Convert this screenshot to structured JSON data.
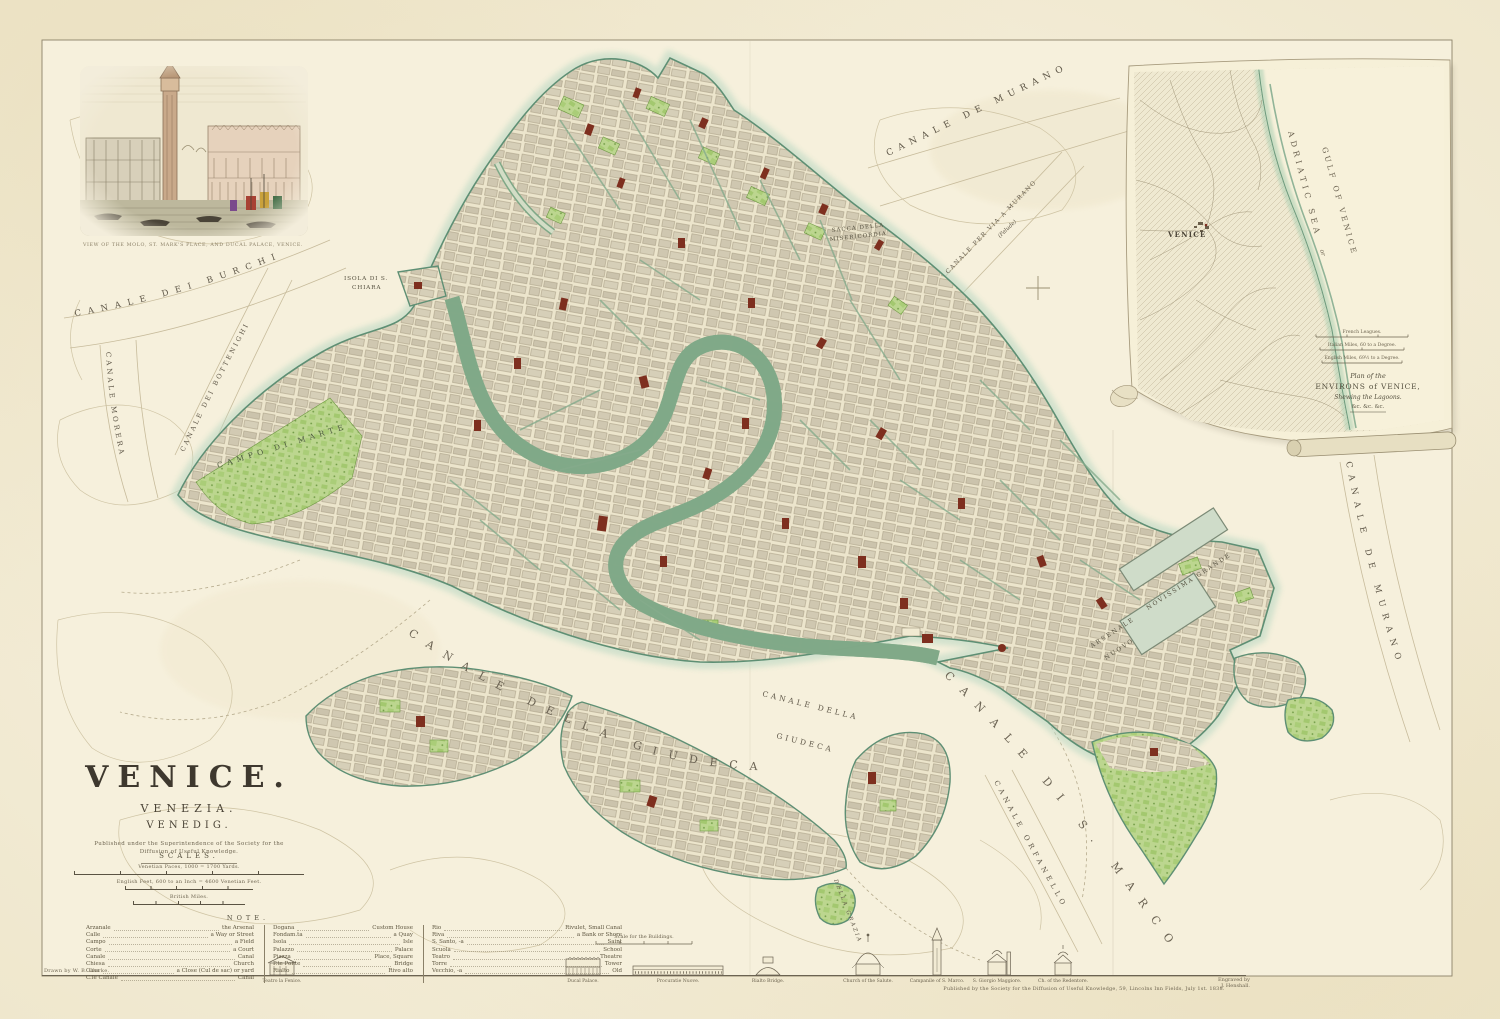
{
  "page": {
    "paper": "#f3eddb",
    "ink": "#5f5748",
    "coast": "#7ba68b",
    "water": "#f6f0dc",
    "land": "#d5cebb",
    "garden": "#b9d48b",
    "landmark": "#7e2f1f"
  },
  "title_block": {
    "title": "VENICE.",
    "subtitle1": "VENEZIA.",
    "subtitle2": "VENEDIG.",
    "imprint_line1": "Published under the Superintendence of the Society for the",
    "imprint_line2": "Diffusion of Useful Knowledge."
  },
  "scales_block": {
    "heading": "SCALES.",
    "bars": [
      {
        "label": "Venetian Paces, 1000 = 1700 Yards."
      },
      {
        "label": "English Feet, 600 to an Inch = 4600 Venetian Feet."
      },
      {
        "label": "British Miles."
      }
    ]
  },
  "note_block": {
    "heading": "NOTE.",
    "col1": [
      {
        "term": "Arzanale",
        "def": "the Arsenal"
      },
      {
        "term": "Calle",
        "def": "a Way or Street"
      },
      {
        "term": "Campo",
        "def": "a Field"
      },
      {
        "term": "Corte",
        "def": "a Court"
      },
      {
        "term": "Canale",
        "def": "Canal"
      },
      {
        "term": "Chiesa",
        "def": "Church"
      },
      {
        "term": "Casa",
        "def": "a Close (Cul de sac) or yard"
      },
      {
        "term": "C.le Canale",
        "def": "Canal"
      }
    ],
    "col2": [
      {
        "term": "Dogana",
        "def": "Custom House"
      },
      {
        "term": "Fondam.ta",
        "def": "a Quay"
      },
      {
        "term": "Isola",
        "def": "Isle"
      },
      {
        "term": "Palazzo",
        "def": "Palace"
      },
      {
        "term": "Piazza",
        "def": "Place, Square"
      },
      {
        "term": "P.te Ponte",
        "def": "Bridge"
      },
      {
        "term": "Rialto",
        "def": "Rivo alto"
      }
    ],
    "col3": [
      {
        "term": "Rio",
        "def": "Rivulet, Small Canal"
      },
      {
        "term": "Riva",
        "def": "a Bank or Shore"
      },
      {
        "term": "S. Santo, -a",
        "def": "Saint"
      },
      {
        "term": "Scuola",
        "def": "School"
      },
      {
        "term": "Teatro",
        "def": "Theatre"
      },
      {
        "term": "Torre",
        "def": "Tower"
      },
      {
        "term": "Vecchio, -a",
        "def": "Old"
      }
    ]
  },
  "vignette": {
    "caption": "VIEW OF THE MOLO, ST. MARK'S PLACE, AND DUCAL PALACE, VENICE."
  },
  "map_labels": {
    "burchi": "CANALE DEI BURCHI",
    "morera": "CANALE MORERA",
    "bottenighi": "CANALE DEI BOTTENIGHI",
    "murano_top": "CANALE DE MURANO",
    "per_via_murano": "CANALE PER VIA A MURANO",
    "palude": "(Palude)",
    "sacca_line1": "SACCA DELLA",
    "sacca_line2": "MISERICORDIA",
    "isola_chiara_line1": "ISOLA DI S.",
    "isola_chiara_line2": "CHIARA",
    "campo_di_marte": "CAMPO DI MARTE",
    "giudeca_curve": "CANALE DELLA GIUDECA",
    "giudeca2_line1": "CANALE DELLA",
    "giudeca2_line2": "GIUDECA",
    "s_marco": "CANALE DI S. MARCO",
    "orfanello": "CANALE ORFANELLO",
    "murano_right": "CANALE DE MURANO",
    "arsenale_line1": "ARSENALE",
    "arsenale_line2": "NUOVO",
    "novissima": "NOVISSIMA GRANDE",
    "della_grazia": "DELLA GRAZIA"
  },
  "inset": {
    "venice": "VENICE",
    "sea_primary": "ADRIATIC SEA",
    "sea_or": "or",
    "sea_secondary": "GULF OF VENICE",
    "caption_line1": "Plan of the",
    "caption_line2": "ENVIRONS of VENICE,",
    "caption_line3": "Shewing the Lagoons.",
    "caption_line4": "&c. &c. &c.",
    "scales": [
      {
        "label": "French Leagues."
      },
      {
        "label": "Italian Miles, 60 to a Degree."
      },
      {
        "label": "English Miles, 69½ to a Degree."
      }
    ]
  },
  "bottom_strip": {
    "building_scale_label": "Scale for the Buildings.",
    "drawn_by": "Drawn by W. B. Clarke.",
    "engraved_by_line1": "Engraved by",
    "engraved_by_line2": "J. Henshall.",
    "imprint": "Published by the Society for the Diffusion of Useful Knowledge, 59, Lincolns Inn Fields, July 1st. 1838.",
    "profiles": [
      {
        "caption": "Teatro la Fenice."
      },
      {
        "caption": "Ducal Palace."
      },
      {
        "caption": "Procuratie Nuove."
      },
      {
        "caption": "Rialto Bridge."
      },
      {
        "caption": "Church of the Salute."
      },
      {
        "caption": "Campanile of S. Marco."
      },
      {
        "caption": "S. Giorgio Maggiore."
      },
      {
        "caption": "Ch. of the Redentore."
      }
    ]
  }
}
